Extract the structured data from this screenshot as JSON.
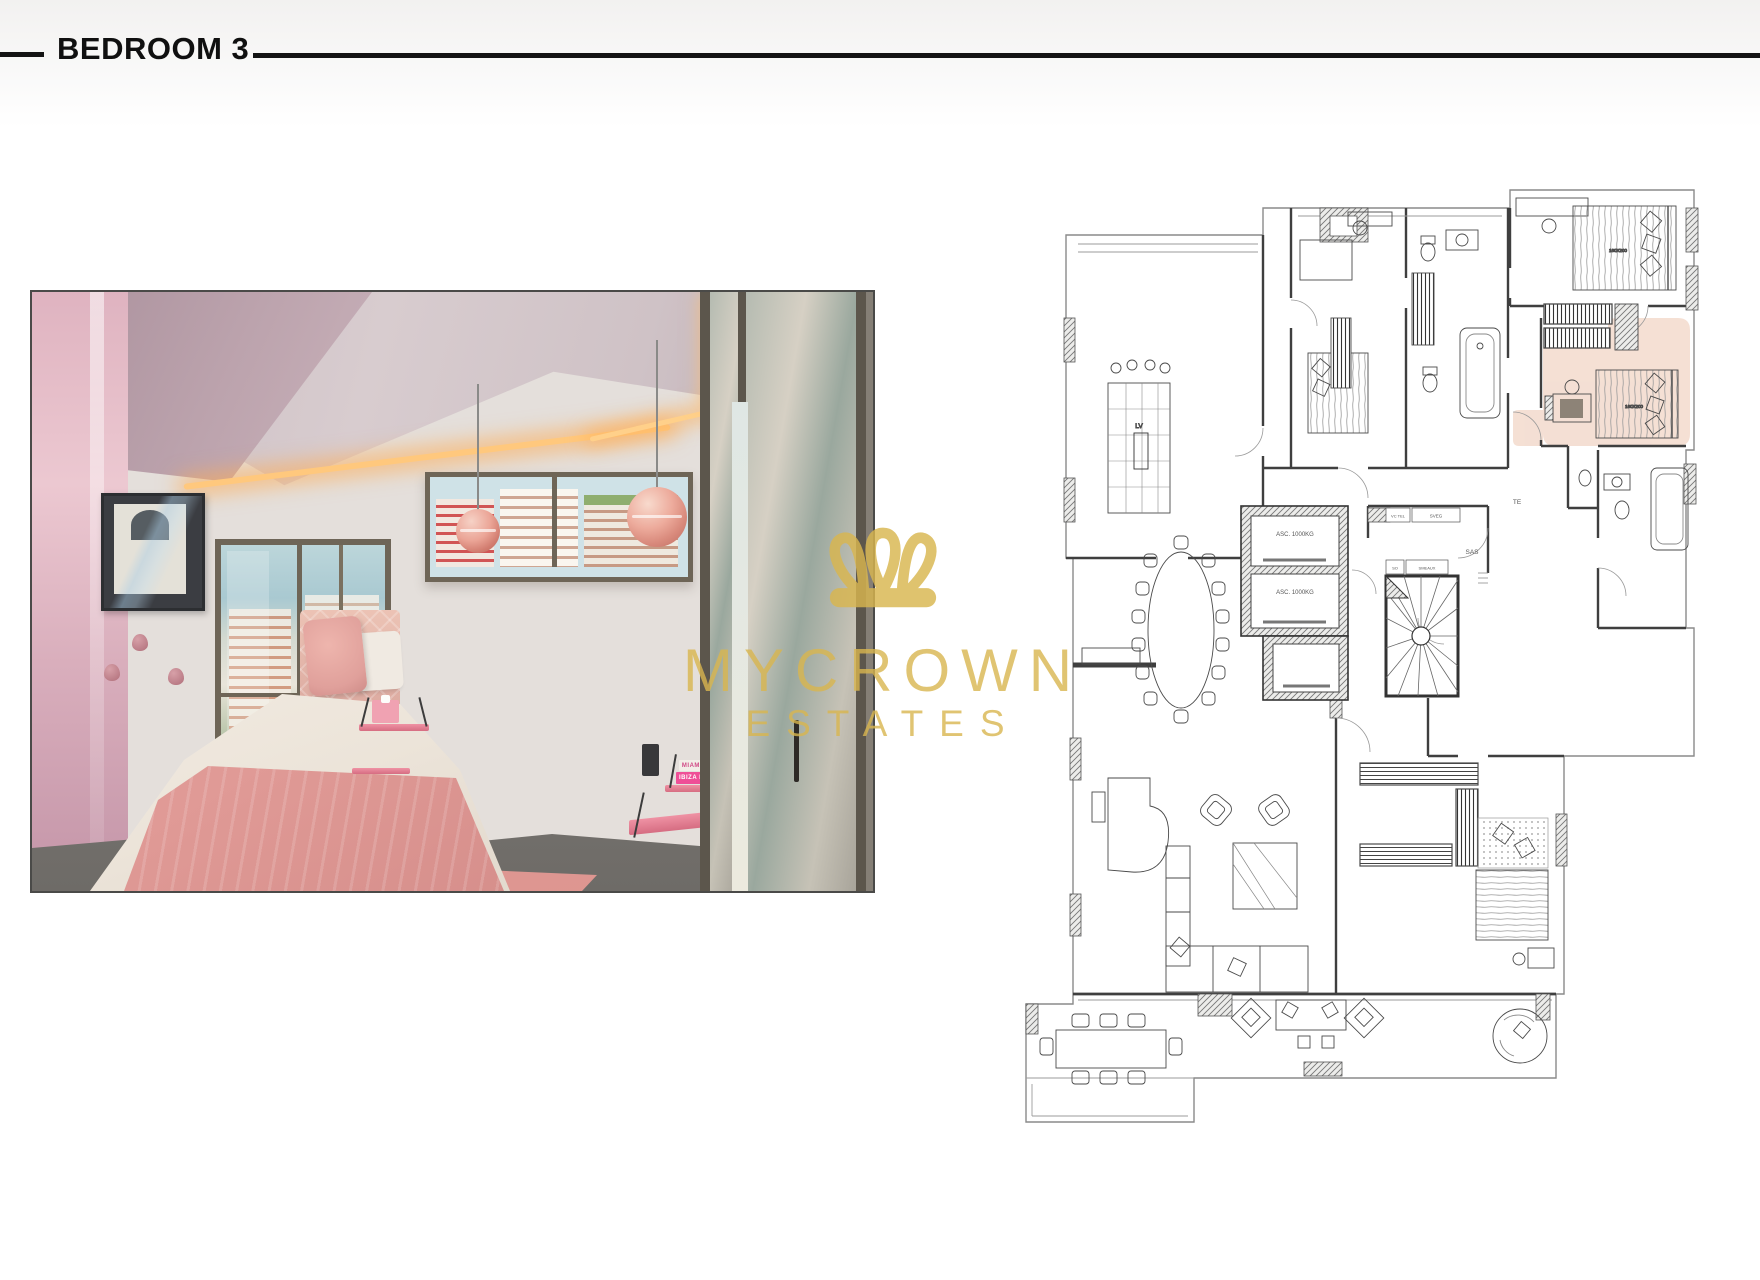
{
  "header": {
    "title": "BEDROOM 3"
  },
  "watermark": {
    "brand_top": "MYCROWN",
    "brand_bottom": "ESTATES",
    "color": "#D9B64F"
  },
  "photo": {
    "books": {
      "top": "MIAMI BEACH",
      "bottom": "IBIZA BOHEMIA"
    }
  },
  "floor_plan": {
    "highlight_color": "#F2D7C8",
    "labels": {
      "elevator_1": "ASC. 1000KG",
      "elevator_2": "ASC. 1000KG",
      "dishwasher": "LV",
      "sas": "SAS",
      "te": "TE",
      "so": "SO",
      "sveg": "SVEG",
      "vc_tel": "VC TEL",
      "smeaux": "SMEAUX",
      "bed_size_bedroom2": "160X200",
      "bed_size_bedroom3": "160X200"
    }
  }
}
